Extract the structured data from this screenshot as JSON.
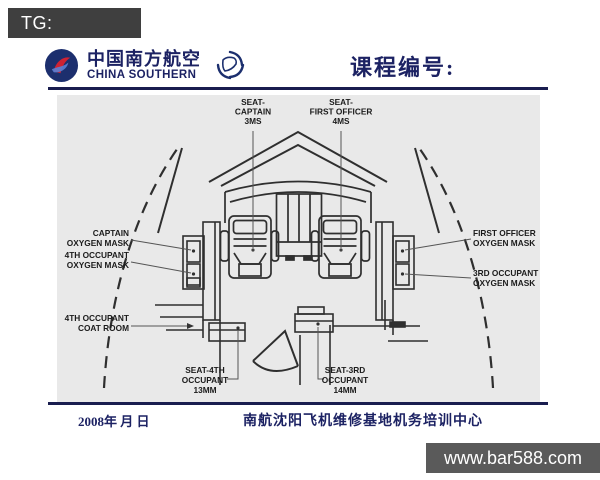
{
  "watermarks": {
    "top_left": "TG: MYYJJPP",
    "bottom_right": "www.bar588.com"
  },
  "header": {
    "airline_name_cn": "中国南方航空",
    "airline_name_en": "CHINA SOUTHERN",
    "course_label": "课程编号:"
  },
  "footer": {
    "date_line": "2008年  月  日",
    "training_center": "南航沈阳飞机维修基地机务培训中心"
  },
  "diagram": {
    "type": "cockpit-seating-top-view",
    "labels": {
      "seat_captain": [
        "SEAT-",
        "CAPTAIN",
        "3MS"
      ],
      "seat_first_officer": [
        "SEAT-",
        "FIRST OFFICER",
        "4MS"
      ],
      "captain_oxygen_mask": [
        "CAPTAIN",
        "OXYGEN MASK"
      ],
      "occupant4_oxygen_mask": [
        "4TH OCCUPANT",
        "OXYGEN MASK"
      ],
      "occupant4_coat_room": [
        "4TH OCCUPANT",
        "COAT ROOM"
      ],
      "first_officer_oxygen_mask": [
        "FIRST OFFICER",
        "OXYGEN MASK"
      ],
      "occupant3_oxygen_mask": [
        "3RD OCCUPANT",
        "OXYGEN MASK"
      ],
      "seat_occupant4": [
        "SEAT-4TH",
        "OCCUPANT",
        "13MM"
      ],
      "seat_occupant3": [
        "SEAT-3RD",
        "OCCUPANT",
        "14MM"
      ]
    }
  },
  "icons": {
    "airline_logo": "china-southern-roundel",
    "alliance_logo": "skyteam-swirl"
  },
  "colors": {
    "navy": "#1c2263",
    "rule": "#191d4f",
    "diagram_bg": "#e9e9e9",
    "diagram_line": "#2f2f2f",
    "watermark_dark": "#3f3f3f",
    "watermark_gray": "#5a5a5a",
    "logo_red": "#cf2233",
    "logo_blue": "#1c2f6e"
  }
}
